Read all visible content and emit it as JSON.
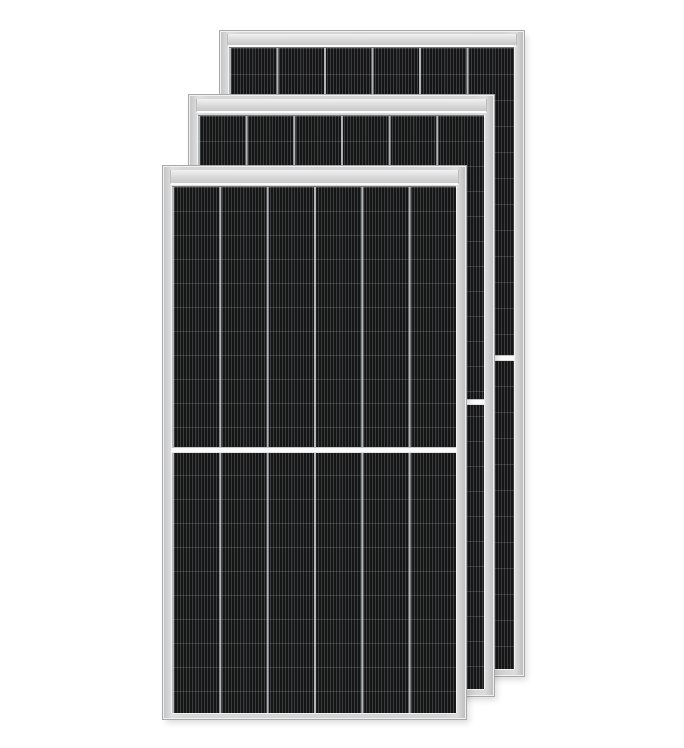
{
  "scene": {
    "type": "product-photo",
    "alt": "Three overlapping black monocrystalline half-cut solar panels with silver aluminum frames, stacked diagonally on a white background",
    "subject": "solar-panels",
    "panel_count": 3,
    "palette": {
      "background": "#ffffff",
      "frame": "#d6d6d6",
      "frame_edge_light": "#f0f0f0",
      "frame_edge_dark": "#a7aaac",
      "band_gradient_top": "#f1f1f1",
      "band_gradient_bottom": "#c7c7c7",
      "band_underline": "#fbfbfb",
      "cell_dark": "#1d1d1f",
      "cell_stripe": "#3a3c3e",
      "column_line": "#b2b6b9",
      "row_line": "rgba(235,235,235,0.16)",
      "divider": "#fafafa"
    },
    "panels": [
      {
        "position": "back",
        "z": 1,
        "left": 220,
        "top": 31,
        "width": 302,
        "height": 643,
        "band_top": 2,
        "band_height": 11,
        "cells_top": 15,
        "cells_bottom": 6,
        "cells_left": 8,
        "cells_right": 9,
        "columns": 6,
        "row_pitch_px": 26,
        "has_center_divider": true
      },
      {
        "position": "middle",
        "z": 2,
        "left": 189,
        "top": 95,
        "width": 303,
        "height": 599,
        "band_top": 3,
        "band_height": 12,
        "cells_top": 19,
        "cells_bottom": 6,
        "cells_left": 8,
        "cells_right": 9,
        "columns": 6,
        "row_pitch_px": 25,
        "has_center_divider": true
      },
      {
        "position": "front",
        "z": 3,
        "left": 163,
        "top": 166,
        "width": 301,
        "height": 551,
        "band_top": 3,
        "band_height": 13,
        "cells_top": 19,
        "cells_bottom": 5,
        "cells_left": 8,
        "cells_right": 9,
        "columns": 6,
        "row_pitch_px": 24,
        "has_center_divider": true
      }
    ]
  }
}
